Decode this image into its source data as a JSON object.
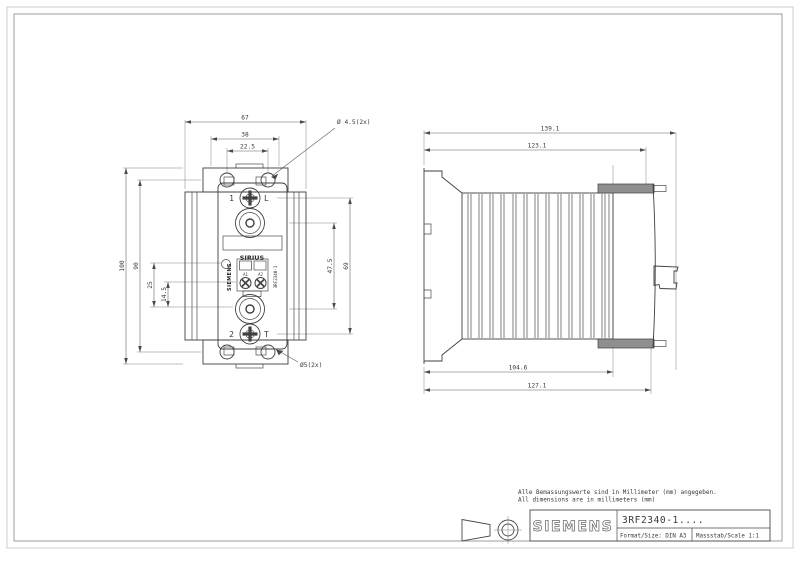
{
  "front_view": {
    "dim_width_outer": "67",
    "dim_width_flange": "38",
    "dim_hole_spacing_h": "22.5",
    "dim_height_outer": "100",
    "dim_hole_spacing_v": "90",
    "dim_led_offset": "25",
    "dim_coil_offset": "14.5",
    "dim_terminal_span": "47.5",
    "dim_screw_span": "69",
    "label_hole_top": "Ø 4.5(2x)",
    "label_hole_bottom": "Ø5(2x)",
    "terminal_top_number": "1",
    "terminal_top_letter": "L",
    "terminal_bottom_number": "2",
    "terminal_bottom_letter": "T",
    "product_family": "SIRIUS",
    "coil_terminal_a1": "A1",
    "coil_terminal_a2": "A2",
    "brand_vertical": "SIEMENS",
    "model_vertical": "3RF2340-1"
  },
  "side_view": {
    "dim_depth_max": "139.1",
    "dim_depth_body": "123.1",
    "dim_depth_rail": "104.6",
    "dim_depth_bracket": "127.1"
  },
  "notes": {
    "line_de": "Alle Bemassungswerte sind in Millimeter (mm) angegeben.",
    "line_en": "All dimensions are in millimeters (mm)"
  },
  "title_block": {
    "brand": "SIEMENS",
    "part_number": "3RF2340-1....",
    "format": "Format/Size: DIN A3",
    "scale": "Massstab/Scale 1:1"
  },
  "colors": {
    "line": "#3f3f3f",
    "frame_outer": "#cccccc",
    "frame_inner": "#9e9e9e"
  }
}
